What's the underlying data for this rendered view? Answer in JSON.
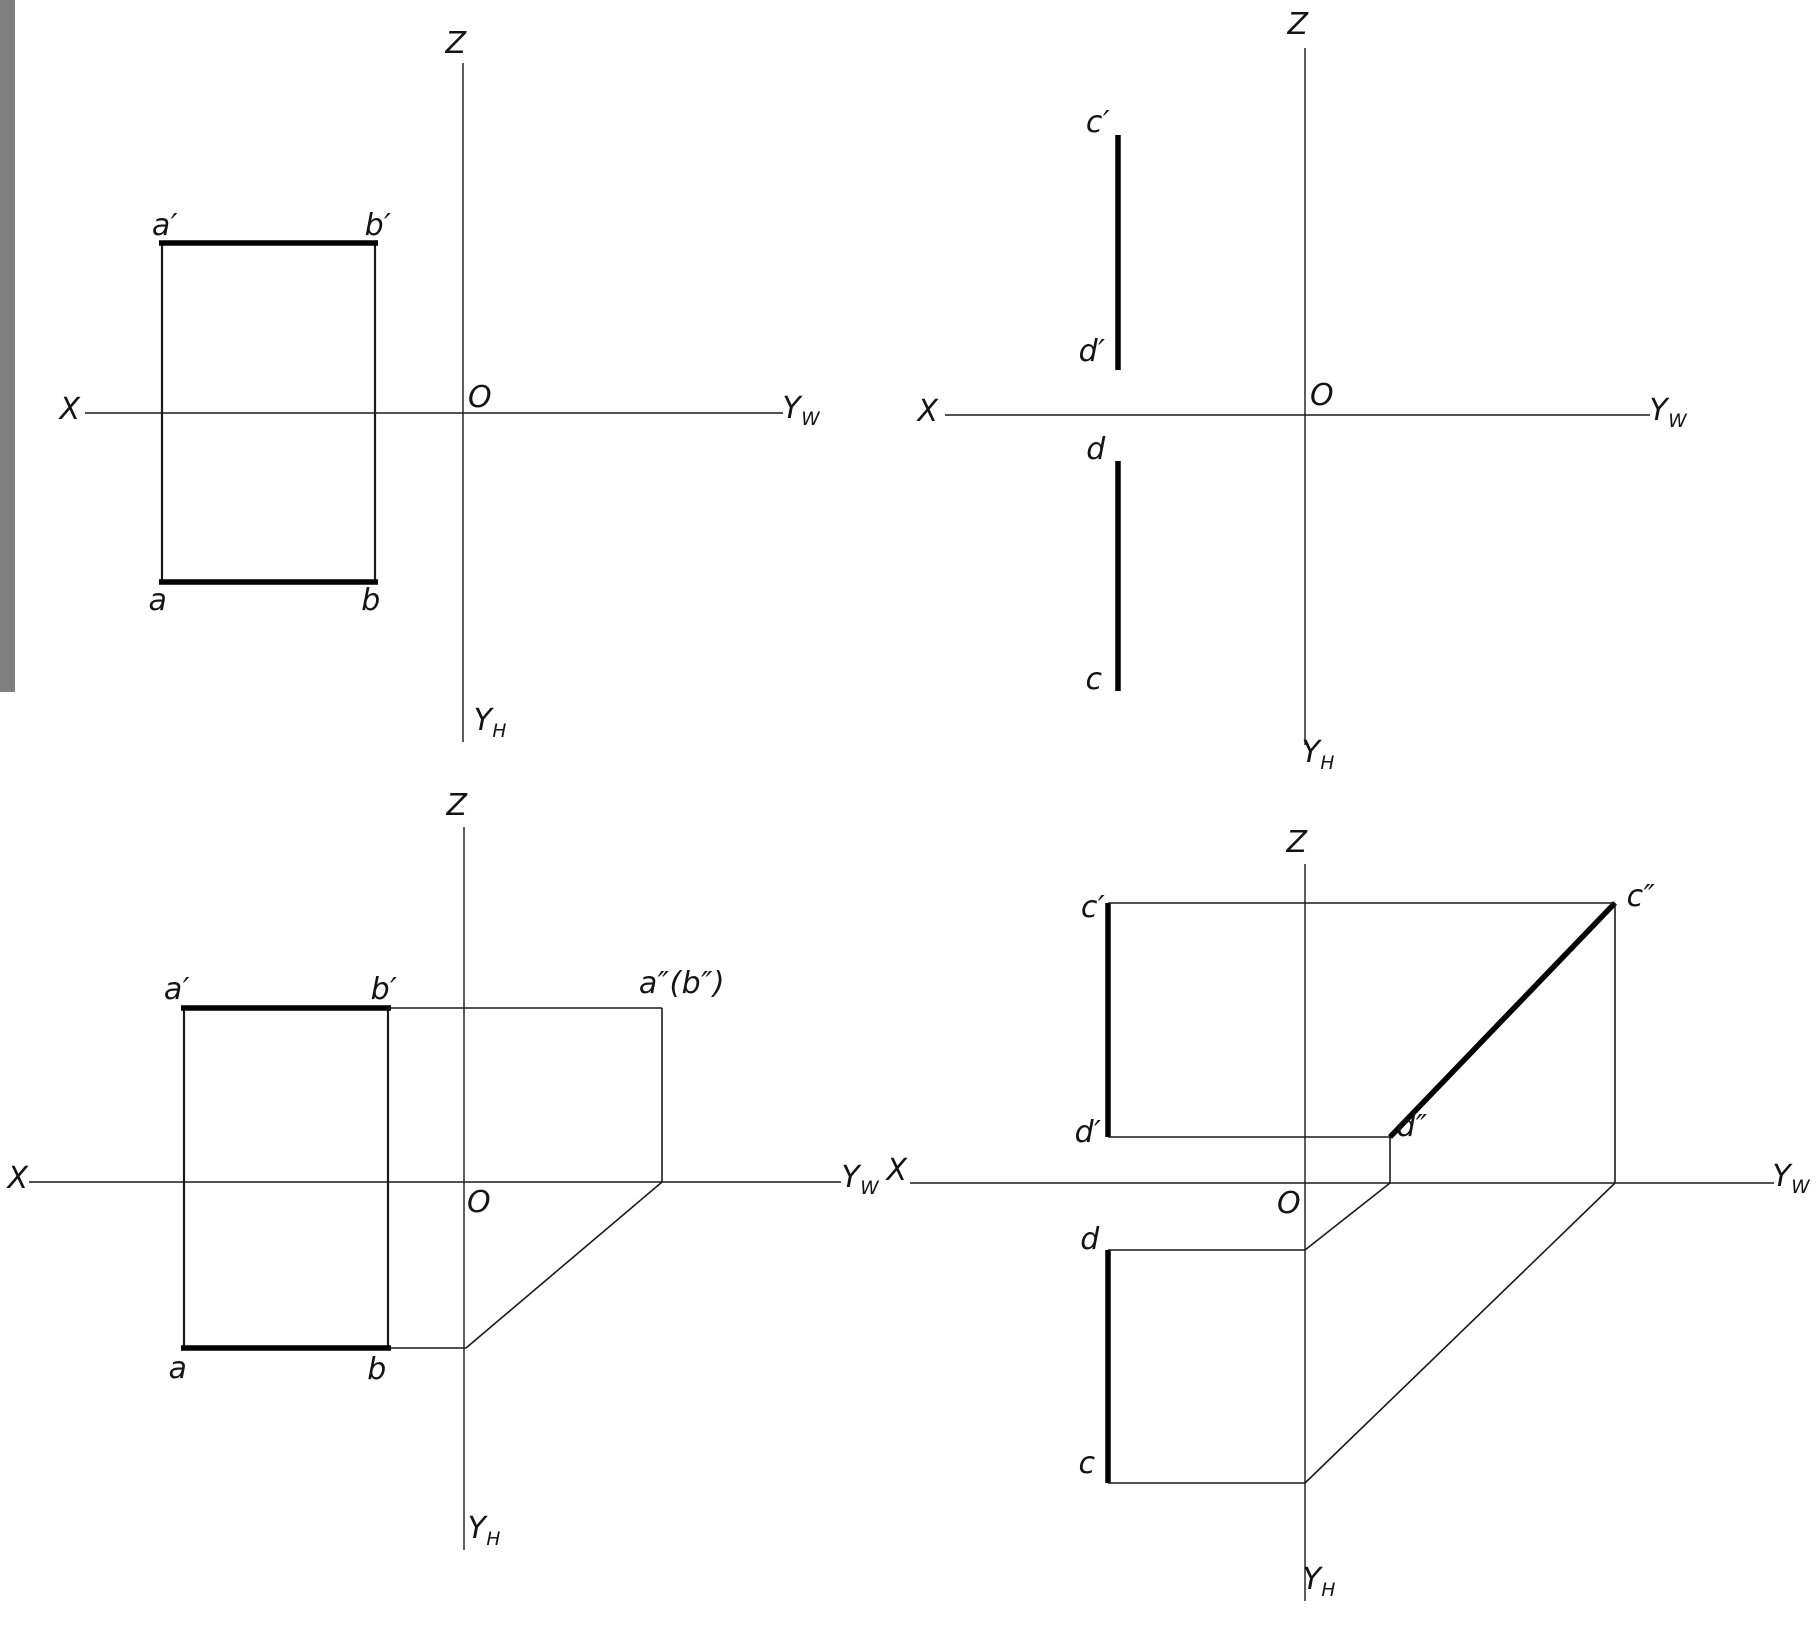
{
  "page": {
    "width": 1817,
    "height": 1629,
    "background": "#ffffff",
    "ink": "#1a1a1a",
    "thick_ink": "#000000"
  },
  "gray_strip": {
    "color": "#808080",
    "x": 0,
    "y": 0,
    "width": 15,
    "height": 692
  },
  "line_weights": {
    "axis": 1.4,
    "thin": 1.6,
    "side": 2.2,
    "thick": 5.5
  },
  "panels": [
    {
      "id": "top-left",
      "lines": [
        {
          "name": "z-axis",
          "w": "axis",
          "x1": 463,
          "y1": 63,
          "x2": 463,
          "y2": 742
        },
        {
          "name": "x-axis",
          "w": "axis",
          "x1": 85,
          "y1": 413,
          "x2": 783,
          "y2": 413
        },
        {
          "name": "rect-left-side",
          "w": "side",
          "x1": 162,
          "y1": 243,
          "x2": 162,
          "y2": 582
        },
        {
          "name": "rect-right-side",
          "w": "side",
          "x1": 375,
          "y1": 243,
          "x2": 375,
          "y2": 582
        },
        {
          "name": "segment-ab-front-thick",
          "w": "thick",
          "x1": 159,
          "y1": 243,
          "x2": 378,
          "y2": 243
        },
        {
          "name": "segment-ab-top-thick",
          "w": "thick",
          "x1": 159,
          "y1": 582,
          "x2": 378,
          "y2": 582
        }
      ],
      "labels": [
        {
          "name": "z",
          "text": "Z",
          "x": 456,
          "y": 44
        },
        {
          "name": "o",
          "text": "O",
          "x": 480,
          "y": 398
        },
        {
          "name": "x",
          "text": "X",
          "x": 70,
          "y": 410
        },
        {
          "name": "yw",
          "text": "Y",
          "sub": "W",
          "x": 801,
          "y": 412
        },
        {
          "name": "yh",
          "text": "Y",
          "sub": "H",
          "x": 490,
          "y": 724
        },
        {
          "name": "a-prime",
          "text": "a′",
          "x": 165,
          "y": 226
        },
        {
          "name": "b-prime",
          "text": "b′",
          "x": 378,
          "y": 226
        },
        {
          "name": "a",
          "text": "a",
          "x": 158,
          "y": 601
        },
        {
          "name": "b",
          "text": "b",
          "x": 371,
          "y": 601
        }
      ]
    },
    {
      "id": "top-right",
      "lines": [
        {
          "name": "z-axis",
          "w": "axis",
          "x1": 1305,
          "y1": 48,
          "x2": 1305,
          "y2": 745
        },
        {
          "name": "x-axis",
          "w": "axis",
          "x1": 945,
          "y1": 415,
          "x2": 1650,
          "y2": 415
        },
        {
          "name": "segment-cd-front-thick",
          "w": "thick",
          "x1": 1118,
          "y1": 135,
          "x2": 1118,
          "y2": 370
        },
        {
          "name": "segment-cd-top-thick",
          "w": "thick",
          "x1": 1118,
          "y1": 461,
          "x2": 1118,
          "y2": 691
        }
      ],
      "labels": [
        {
          "name": "z",
          "text": "Z",
          "x": 1298,
          "y": 25
        },
        {
          "name": "o",
          "text": "O",
          "x": 1322,
          "y": 396
        },
        {
          "name": "x",
          "text": "X",
          "x": 928,
          "y": 412
        },
        {
          "name": "yw",
          "text": "Y",
          "sub": "W",
          "x": 1668,
          "y": 414
        },
        {
          "name": "yh",
          "text": "Y",
          "sub": "H",
          "x": 1318,
          "y": 756
        },
        {
          "name": "c-prime",
          "text": "c′",
          "x": 1098,
          "y": 123
        },
        {
          "name": "d-prime",
          "text": "d′",
          "x": 1092,
          "y": 352
        },
        {
          "name": "d",
          "text": "d",
          "x": 1096,
          "y": 450
        },
        {
          "name": "c",
          "text": "c",
          "x": 1094,
          "y": 680
        }
      ]
    },
    {
      "id": "bottom-left",
      "lines": [
        {
          "name": "z-axis",
          "w": "axis",
          "x1": 464,
          "y1": 827,
          "x2": 464,
          "y2": 1550
        },
        {
          "name": "x-axis",
          "w": "axis",
          "x1": 29,
          "y1": 1182,
          "x2": 841,
          "y2": 1182
        },
        {
          "name": "rect-left-side",
          "w": "side",
          "x1": 184,
          "y1": 1008,
          "x2": 184,
          "y2": 1348
        },
        {
          "name": "rect-right-side",
          "w": "side",
          "x1": 388,
          "y1": 1008,
          "x2": 388,
          "y2": 1348
        },
        {
          "name": "segment-ab-front-thick",
          "w": "thick",
          "x1": 181,
          "y1": 1008,
          "x2": 391,
          "y2": 1008
        },
        {
          "name": "segment-ab-top-thick",
          "w": "thick",
          "x1": 181,
          "y1": 1348,
          "x2": 391,
          "y2": 1348
        },
        {
          "name": "projection-top-horizontal",
          "w": "thin",
          "x1": 388,
          "y1": 1008,
          "x2": 662,
          "y2": 1008
        },
        {
          "name": "projection-side-drop",
          "w": "thin",
          "x1": 662,
          "y1": 1008,
          "x2": 662,
          "y2": 1182
        },
        {
          "name": "transfer-diagonal-45",
          "w": "thin",
          "x1": 662,
          "y1": 1182,
          "x2": 466,
          "y2": 1348
        },
        {
          "name": "projection-bottom-horizontal",
          "w": "thin",
          "x1": 388,
          "y1": 1348,
          "x2": 466,
          "y2": 1348
        }
      ],
      "labels": [
        {
          "name": "z",
          "text": "Z",
          "x": 457,
          "y": 806
        },
        {
          "name": "o",
          "text": "O",
          "x": 479,
          "y": 1203
        },
        {
          "name": "x",
          "text": "X",
          "x": 18,
          "y": 1179
        },
        {
          "name": "yw",
          "text": "Y",
          "sub": "W",
          "x": 860,
          "y": 1181
        },
        {
          "name": "yh",
          "text": "Y",
          "sub": "H",
          "x": 484,
          "y": 1532
        },
        {
          "name": "a-prime",
          "text": "a′",
          "x": 177,
          "y": 990
        },
        {
          "name": "b-prime",
          "text": "b′",
          "x": 384,
          "y": 990
        },
        {
          "name": "a",
          "text": "a",
          "x": 178,
          "y": 1369
        },
        {
          "name": "b",
          "text": "b",
          "x": 377,
          "y": 1370
        },
        {
          "name": "a-b-double-prime",
          "text": "a″(b″)",
          "x": 682,
          "y": 984
        }
      ]
    },
    {
      "id": "bottom-right",
      "lines": [
        {
          "name": "z-axis",
          "w": "axis",
          "x1": 1305,
          "y1": 864,
          "x2": 1305,
          "y2": 1601
        },
        {
          "name": "x-axis",
          "w": "axis",
          "x1": 910,
          "y1": 1183,
          "x2": 1774,
          "y2": 1183
        },
        {
          "name": "segment-cd-front-thick",
          "w": "thick",
          "x1": 1108,
          "y1": 903,
          "x2": 1108,
          "y2": 1137
        },
        {
          "name": "segment-cd-top-thick",
          "w": "thick",
          "x1": 1108,
          "y1": 1250,
          "x2": 1108,
          "y2": 1483
        },
        {
          "name": "segment-cd-side-thick",
          "w": "thick",
          "x1": 1390,
          "y1": 1137,
          "x2": 1615,
          "y2": 903
        },
        {
          "name": "projection-c-prime-horizontal",
          "w": "thin",
          "x1": 1108,
          "y1": 903,
          "x2": 1615,
          "y2": 903
        },
        {
          "name": "projection-d-prime-horizontal",
          "w": "thin",
          "x1": 1108,
          "y1": 1137,
          "x2": 1390,
          "y2": 1137
        },
        {
          "name": "projection-c-side-drop",
          "w": "thin",
          "x1": 1615,
          "y1": 903,
          "x2": 1615,
          "y2": 1183
        },
        {
          "name": "projection-d-side-drop",
          "w": "thin",
          "x1": 1390,
          "y1": 1137,
          "x2": 1390,
          "y2": 1183
        },
        {
          "name": "projection-d-horizontal",
          "w": "thin",
          "x1": 1108,
          "y1": 1250,
          "x2": 1305,
          "y2": 1250
        },
        {
          "name": "transfer-diagonal-d",
          "w": "thin",
          "x1": 1305,
          "y1": 1250,
          "x2": 1390,
          "y2": 1183
        },
        {
          "name": "projection-c-horizontal",
          "w": "thin",
          "x1": 1108,
          "y1": 1483,
          "x2": 1305,
          "y2": 1483
        },
        {
          "name": "transfer-diagonal-c",
          "w": "thin",
          "x1": 1305,
          "y1": 1483,
          "x2": 1615,
          "y2": 1183
        }
      ],
      "labels": [
        {
          "name": "z",
          "text": "Z",
          "x": 1297,
          "y": 843
        },
        {
          "name": "o",
          "text": "O",
          "x": 1289,
          "y": 1204
        },
        {
          "name": "x",
          "text": "X",
          "x": 897,
          "y": 1171
        },
        {
          "name": "yw",
          "text": "Y",
          "sub": "W",
          "x": 1791,
          "y": 1180
        },
        {
          "name": "yh",
          "text": "Y",
          "sub": "H",
          "x": 1319,
          "y": 1583
        },
        {
          "name": "c-prime",
          "text": "c′",
          "x": 1093,
          "y": 908
        },
        {
          "name": "d-prime",
          "text": "d′",
          "x": 1088,
          "y": 1133
        },
        {
          "name": "d",
          "text": "d",
          "x": 1090,
          "y": 1240
        },
        {
          "name": "c",
          "text": "c",
          "x": 1087,
          "y": 1464
        },
        {
          "name": "c-double-prime",
          "text": "c″",
          "x": 1641,
          "y": 897
        },
        {
          "name": "d-double-prime",
          "text": "d″",
          "x": 1412,
          "y": 1127
        }
      ]
    }
  ]
}
